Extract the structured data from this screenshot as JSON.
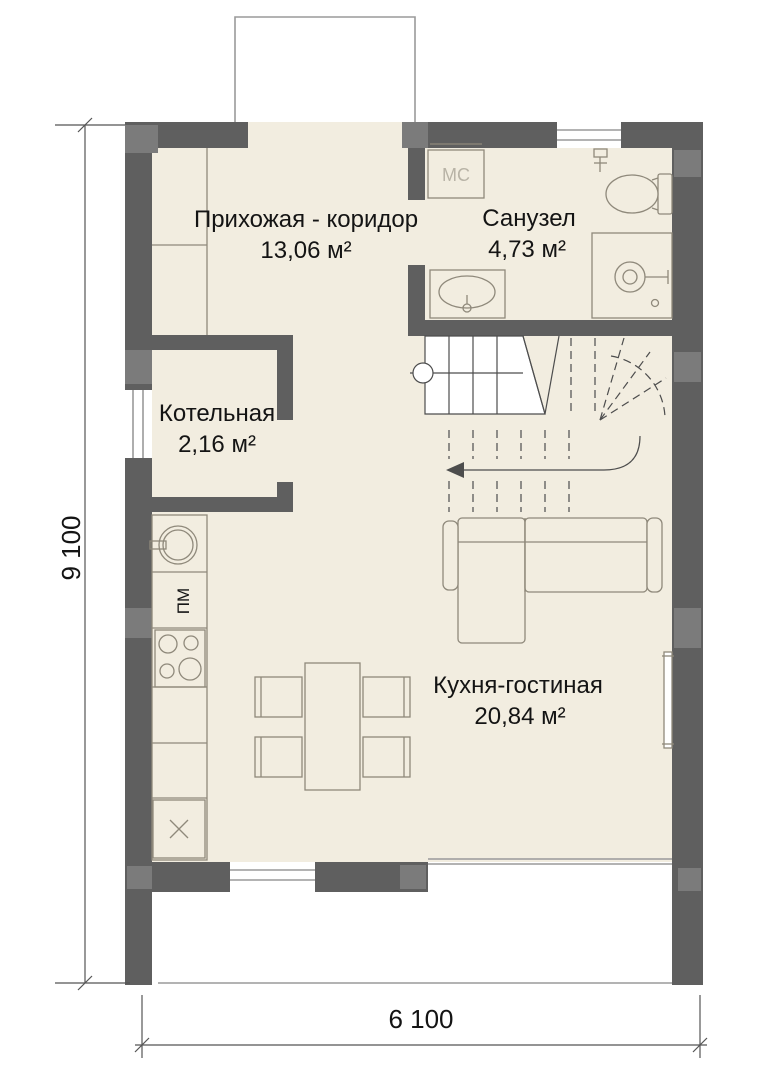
{
  "colors": {
    "floor": "#f2ede0",
    "wall": "#5f5f5f",
    "pillar": "#7b7b7b",
    "furniture": "#8f897b",
    "stair": "#4d4d4d",
    "glazing": "#9a9a9a",
    "dimension": "#555555",
    "text": "#141414",
    "muted": "#b8b3a6"
  },
  "rooms": [
    {
      "name": "Прихожая - коридор",
      "area": "13,06 м²"
    },
    {
      "name": "Санузел",
      "area": "4,73 м²"
    },
    {
      "name": "Котельная",
      "area": "2,16 м²"
    },
    {
      "name": "Кухня-гостиная",
      "area": "20,84 м²"
    }
  ],
  "labels": {
    "washing_machine": "МС",
    "dishwasher": "ПМ"
  },
  "dimensions": {
    "width_label": "6 100",
    "height_label": "9 100"
  }
}
